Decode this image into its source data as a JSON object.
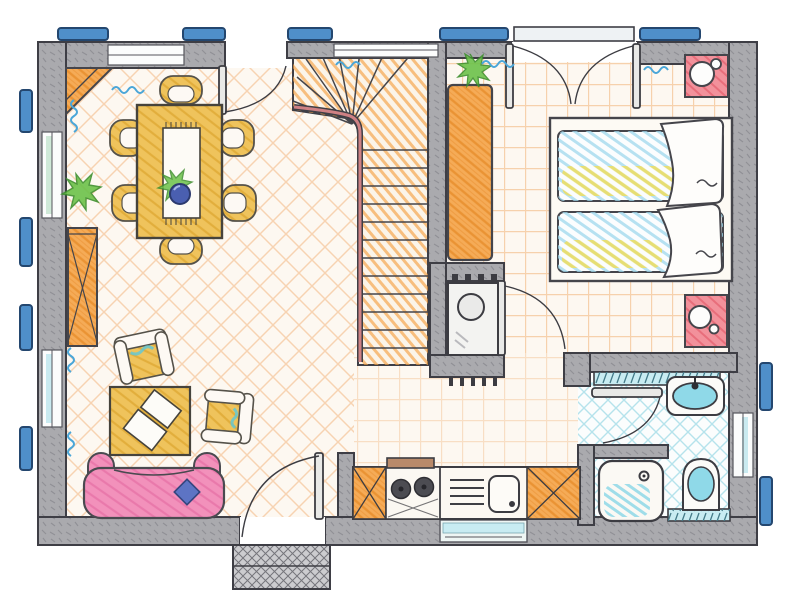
{
  "meta": {
    "kind": "hand-drawn architectural floor plan",
    "style": "colored pencil sketch, top-down view",
    "visible_text": "none"
  },
  "colors": {
    "wall": "#aaaaae",
    "wall_line": "#3e3e45",
    "floor": "#fdf8f1",
    "hatch_orange": "#ef9f5a",
    "grid_orange": "#f0a968",
    "furniture_yellow": "#efc35c",
    "yellow_line": "#dda62f",
    "furniture_orange": "#f5ab57",
    "orange_line": "#e78d2c",
    "stair_orange": "#f4a245",
    "handrail": "#cf8184",
    "sofa_pink": "#f291bb",
    "pink_line": "#e56ba3",
    "cushion_blue": "#5d74c4",
    "bowl_blue": "#4a5fb0",
    "bathroom_cyan": "#8fd9e8",
    "cyan_hatch": "#5fc3d8",
    "radiator_cyan": "#c8ecf2",
    "window_bar_blue": "#4f8fc9",
    "window_bar_edge": "#24476f",
    "curtain_blue": "#4aa6d8",
    "nightstand_red": "#f2919b",
    "red_line": "#e4606e",
    "plant_green": "#6cc24a",
    "plant_green_dark": "#3f8f2f",
    "bed_cyan": "#9fd8ec",
    "bed_yellow": "#f2dd55",
    "bed_green": "#8fcf6a",
    "hood_brown": "#b98a6a",
    "burner_dark": "#4c4c52",
    "porch_gray": "#cccccf"
  },
  "rooms": [
    {
      "id": "living-dining-room",
      "floor_finish": "orange diagonal crosshatch",
      "items": [
        "corner-shelf",
        "dining-table",
        "table-runner",
        "fruit-bowl",
        "table-plant",
        "dining-chair x6",
        "floor-plant",
        "bookshelf",
        "armchair x2",
        "coffee-table",
        "magazines x2",
        "sofa",
        "sofa-cushion"
      ]
    },
    {
      "id": "staircase",
      "items": [
        "winder-stairs",
        "handrail"
      ]
    },
    {
      "id": "hallway",
      "floor_finish": "orange grid hatch",
      "items": [
        "runner-rug",
        "hall-plant",
        "utility-closet",
        "boiler"
      ]
    },
    {
      "id": "bedroom",
      "floor_finish": "orange grid hatch",
      "items": [
        "bed-platform",
        "single-bed x2",
        "duvet x2",
        "nightstand x2"
      ]
    },
    {
      "id": "bathroom",
      "floor_finish": "cyan diagonal crosshatch",
      "items": [
        "wash-basin",
        "toilet",
        "shower",
        "radiator x2"
      ]
    },
    {
      "id": "kitchen",
      "items": [
        "base-cabinet x2",
        "stove-with-2-burners",
        "range-hood",
        "kitchen-sink",
        "drainboard"
      ]
    }
  ],
  "openings": {
    "entrance_door": 1,
    "garden_door": 1,
    "french_double_door": 1,
    "interior_doors": 3,
    "window_shutter_bars_top": 5,
    "window_shutter_bars_left": 4,
    "window_shutter_bars_right": 2,
    "porch_mat": 1
  },
  "counts": {
    "dining_chairs": 6,
    "beds": 2,
    "armchairs": 2,
    "plants": 3,
    "burners": 2
  }
}
